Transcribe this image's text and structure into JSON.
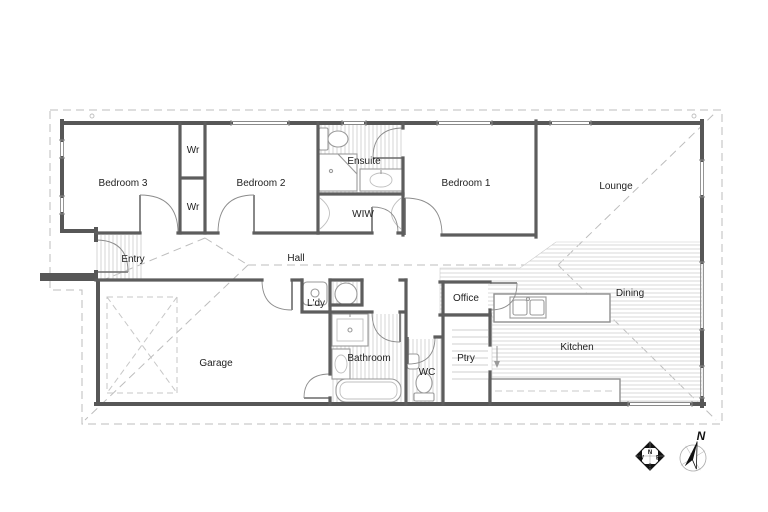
{
  "plan": {
    "rooms": [
      {
        "id": "bedroom-3",
        "label": "Bedroom 3"
      },
      {
        "id": "wr-top",
        "label": "Wr"
      },
      {
        "id": "wr-bottom",
        "label": "Wr"
      },
      {
        "id": "bedroom-2",
        "label": "Bedroom 2"
      },
      {
        "id": "ensuite",
        "label": "Ensuite"
      },
      {
        "id": "wiw",
        "label": "WIW"
      },
      {
        "id": "bedroom-1",
        "label": "Bedroom 1"
      },
      {
        "id": "lounge",
        "label": "Lounge"
      },
      {
        "id": "entry",
        "label": "Entry"
      },
      {
        "id": "hall",
        "label": "Hall"
      },
      {
        "id": "laundry",
        "label": "L'dy"
      },
      {
        "id": "garage",
        "label": "Garage"
      },
      {
        "id": "bathroom",
        "label": "Bathroom"
      },
      {
        "id": "wc",
        "label": "WC"
      },
      {
        "id": "office",
        "label": "Office"
      },
      {
        "id": "pantry",
        "label": "Ptry"
      },
      {
        "id": "kitchen",
        "label": "Kitchen"
      },
      {
        "id": "dining",
        "label": "Dining"
      }
    ],
    "compass_rose": {
      "north": "N",
      "east": "E",
      "south": "S",
      "west": "W"
    },
    "north_arrow": {
      "label": "N"
    },
    "colors": {
      "wall": "#575757",
      "window_line": "#8a8a8a",
      "roof_dashed": "#bdbdbd",
      "hatch": "#d6d6d6",
      "fixture": "#9a9a9a",
      "label_text": "#222222"
    }
  }
}
